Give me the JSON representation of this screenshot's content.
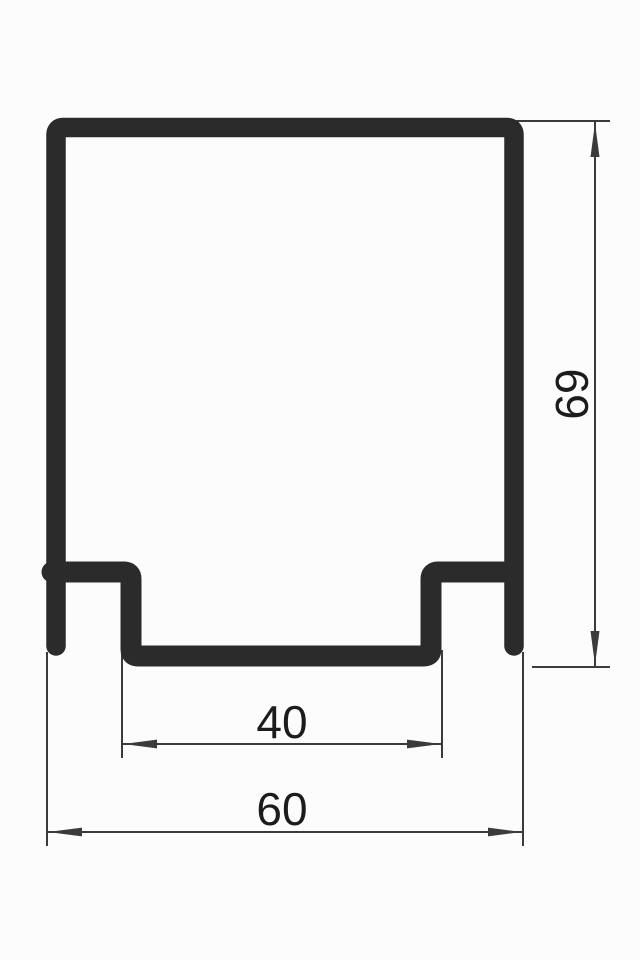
{
  "drawing": {
    "kind": "technical cross-section of a C-channel track profile",
    "dimensions": {
      "height": {
        "value": "69",
        "orientation": "vertical",
        "side": "right"
      },
      "slot_width": {
        "value": "40",
        "orientation": "horizontal",
        "side": "bottom"
      },
      "overall_width": {
        "value": "60",
        "orientation": "horizontal",
        "side": "bottom"
      }
    }
  },
  "colors": {
    "background": "#fcfcfc",
    "profile": "#2b2b2b",
    "dimension_lines": "#3b3b3b",
    "text": "#1c1c1c"
  }
}
